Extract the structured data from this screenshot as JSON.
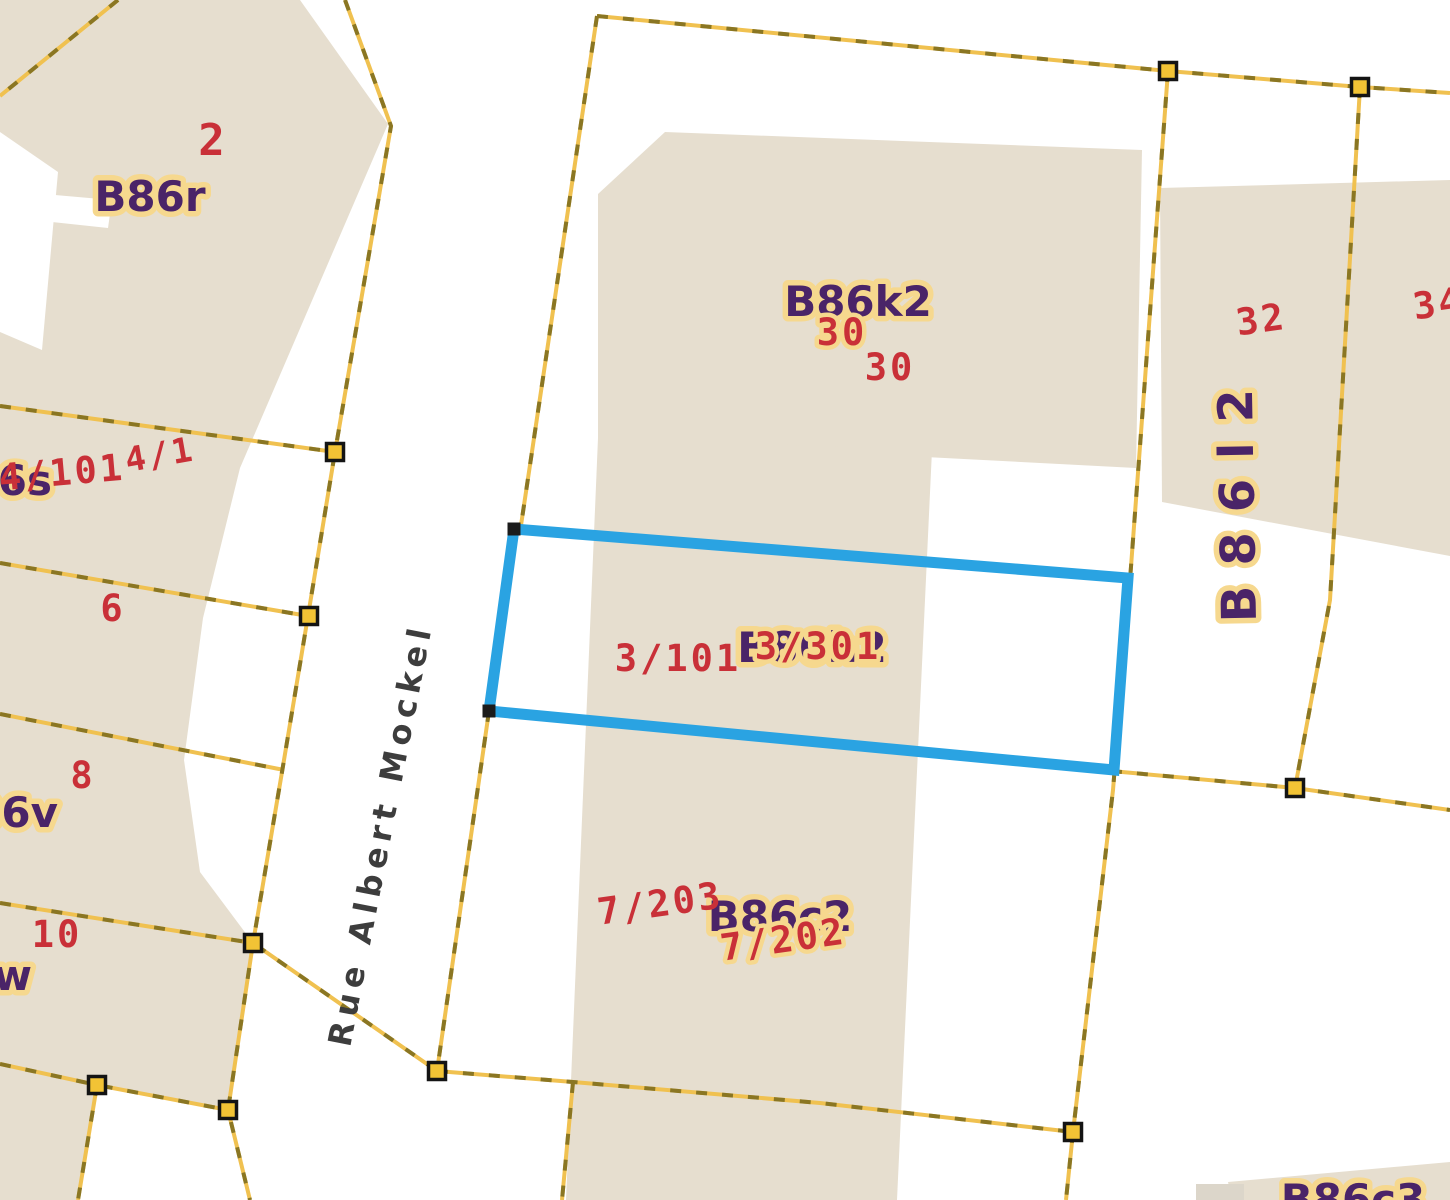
{
  "map": {
    "street_name": "Rue Albert Mockel",
    "house_numbers": [
      "2",
      "4/101",
      "4/1",
      "6",
      "8",
      "10",
      "30",
      "30",
      "32",
      "34",
      "3/101",
      "3/301",
      "7/203",
      "7/202"
    ],
    "parcel_codes": [
      "B86r",
      "B86k2",
      "B86l2",
      "B86h2",
      "B86c2",
      "B86c3",
      "B86s",
      "B86v",
      "B86w"
    ],
    "colors": {
      "selection_outline": "#2aa3e2",
      "parcel_boundary": "#f0c150",
      "parcel_boundary_dash": "#8a7623",
      "building_fill": "#e6decf",
      "house_number_text": "#c93038",
      "parcel_code_text": "#4a2468",
      "label_halo": "#f6d88e",
      "street_text": "#3d3d3d"
    }
  }
}
